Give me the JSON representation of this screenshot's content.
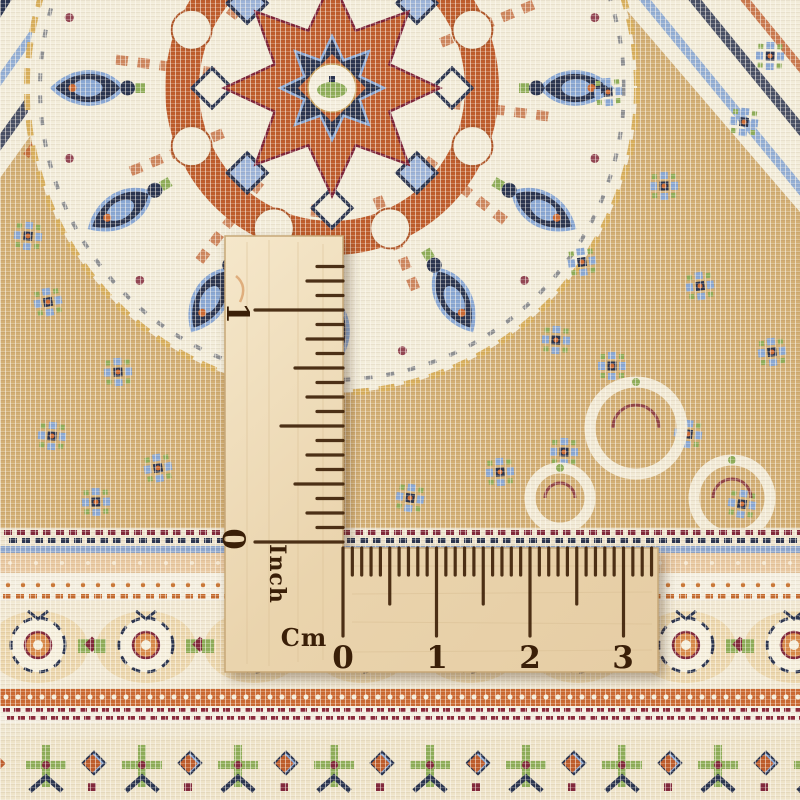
{
  "scene": {
    "type": "photograph",
    "subject": "Close-up of a hand-woven oriental rug with an L-shaped wooden ruler laid on top to show the fineness of the weave",
    "objects": [
      "oriental-rug",
      "wooden-corner-ruler"
    ]
  },
  "ruler": {
    "material": "light wood with burned-in markings",
    "wood_colors": {
      "light": "#f5e7ca",
      "mid": "#ead4ad",
      "dark": "#e0c79e",
      "edge": "#c7a878"
    },
    "mark_color": "#3f2209",
    "inch_scale": {
      "unit_label": "Inch",
      "number_one": "1",
      "number_zero": "0",
      "edge_x": 343,
      "zero_y": 542,
      "pixels_per_sixteenth": 14.5,
      "tick_count": 20,
      "len_inch": 88,
      "len_half": 62,
      "len_quarter": 48,
      "len_eighth": 36,
      "len_sixteenth": 26
    },
    "cm_scale": {
      "unit_label": "Cm",
      "numbers": [
        "0",
        "1",
        "2",
        "3"
      ],
      "edge_y": 548,
      "zero_x": 343,
      "pixels_per_mm": 9.35,
      "tick_count": 34,
      "len_cm": 88,
      "len_halfcm": 56,
      "len_mm": 27
    }
  },
  "rug": {
    "palette": {
      "cream": "#f2ecd9",
      "tan": "#d2ae74",
      "rust": "#bf5d2c",
      "navy": "#2b3550",
      "blue": "#8aa8d4",
      "green": "#8fae5a",
      "maroon": "#82293c",
      "gold": "#d9b05e",
      "peach": "#e9c9a2",
      "white": "#f6f1e4",
      "orange": "#cc6a33",
      "band_cream": "#f1e8d2",
      "blob_peach": "#ecd7ad",
      "rosette_core": "#d98a4a",
      "floral_bg": "#eee3c8"
    },
    "medallion": {
      "cx": 332,
      "cy": 88,
      "r": 305,
      "star_r": 108,
      "inner_star_r": 52,
      "ray_count": 12,
      "boteh_count": 12,
      "boteh_radius": 242,
      "ring_r": 150
    },
    "florets": [
      [
        48,
        302
      ],
      [
        118,
        372
      ],
      [
        52,
        436
      ],
      [
        158,
        468
      ],
      [
        96,
        502
      ],
      [
        28,
        236
      ],
      [
        582,
        262
      ],
      [
        664,
        186
      ],
      [
        744,
        122
      ],
      [
        700,
        286
      ],
      [
        612,
        366
      ],
      [
        688,
        434
      ],
      [
        772,
        352
      ],
      [
        564,
        452
      ],
      [
        742,
        504
      ],
      [
        608,
        92
      ],
      [
        770,
        56
      ],
      [
        410,
        498
      ],
      [
        500,
        472
      ],
      [
        556,
        340
      ]
    ],
    "scrolls": [
      [
        636,
        428,
        46
      ],
      [
        732,
        498,
        38
      ],
      [
        560,
        498,
        30
      ]
    ],
    "bands": [
      {
        "y": 528,
        "h": 18,
        "kind": "dash-duo"
      },
      {
        "y": 546,
        "h": 7,
        "kind": "blue-line"
      },
      {
        "y": 553,
        "h": 20,
        "kind": "peach"
      },
      {
        "y": 573,
        "h": 19,
        "kind": "dot-row"
      },
      {
        "y": 592,
        "h": 9,
        "kind": "orange-dash"
      },
      {
        "y": 601,
        "h": 88,
        "kind": "rosette"
      },
      {
        "y": 689,
        "h": 17,
        "kind": "orange-dots"
      },
      {
        "y": 706,
        "h": 17,
        "kind": "maroon-dash"
      },
      {
        "y": 723,
        "h": 14,
        "kind": "cream"
      },
      {
        "y": 737,
        "h": 63,
        "kind": "floral"
      }
    ]
  }
}
